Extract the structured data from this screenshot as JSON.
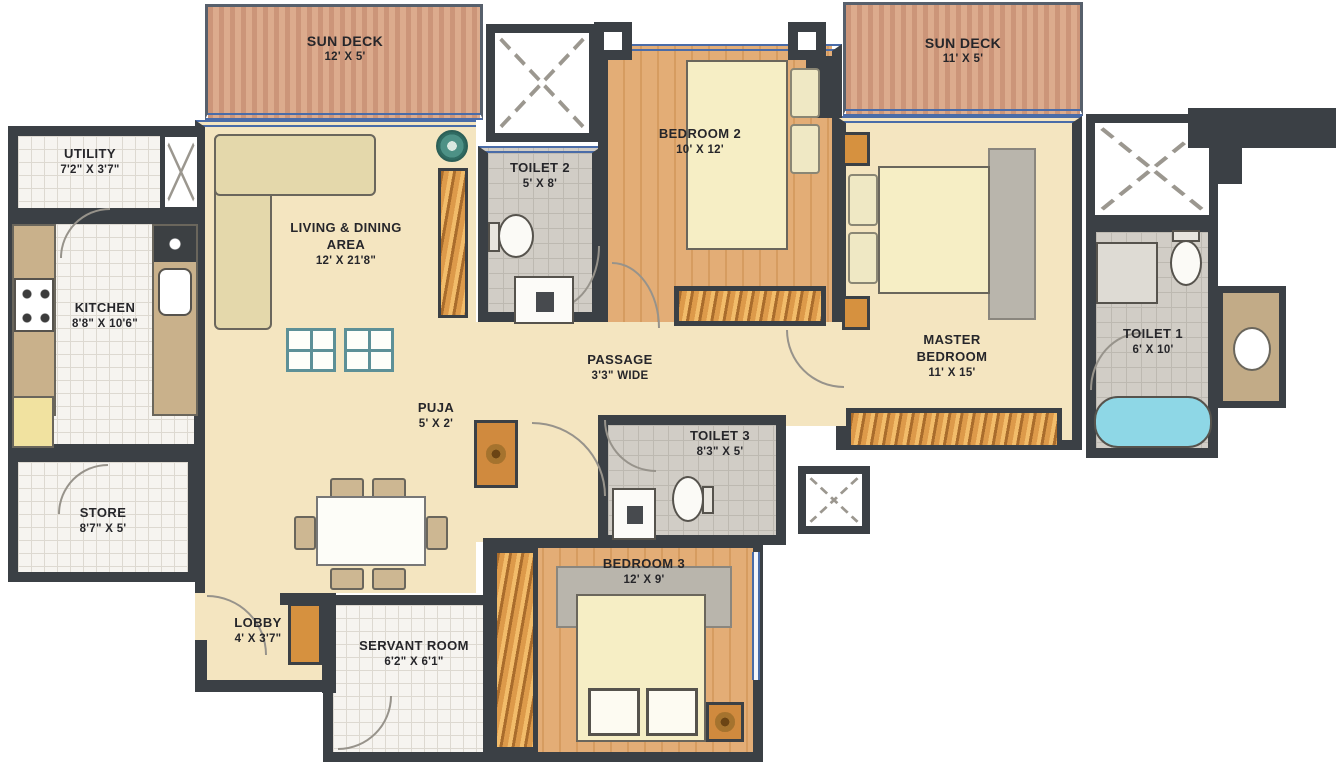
{
  "rooms": {
    "sun_deck_1": {
      "name": "SUN DECK",
      "dims": "12' X 5'"
    },
    "sun_deck_2": {
      "name": "SUN DECK",
      "dims": "11' X 5'"
    },
    "utility": {
      "name": "UTILITY",
      "dims": "7'2\" X 3'7\""
    },
    "kitchen": {
      "name": "KITCHEN",
      "dims": "8'8\" X 10'6\""
    },
    "living_dining": {
      "name": "LIVING & DINING AREA",
      "dims": "12' X 21'8\""
    },
    "toilet_2": {
      "name": "TOILET 2",
      "dims": "5' X 8'"
    },
    "bedroom_2": {
      "name": "BEDROOM 2",
      "dims": "10' X 12'"
    },
    "master_bedroom": {
      "name": "MASTER BEDROOM",
      "dims": "11' X 15'"
    },
    "toilet_1": {
      "name": "TOILET 1",
      "dims": "6' X 10'"
    },
    "passage": {
      "name": "PASSAGE",
      "dims": "3'3\" WIDE"
    },
    "puja": {
      "name": "PUJA",
      "dims": "5' X 2'"
    },
    "toilet_3": {
      "name": "TOILET 3",
      "dims": "8'3\" X 5'"
    },
    "store": {
      "name": "STORE",
      "dims": "8'7\" X 5'"
    },
    "lobby": {
      "name": "LOBBY",
      "dims": "4' X 3'7\""
    },
    "servant_room": {
      "name": "SERVANT ROOM",
      "dims": "6'2\" X 6'1\""
    },
    "bedroom_3": {
      "name": "BEDROOM 3",
      "dims": "12' X 9'"
    }
  },
  "colors": {
    "wall": "#3b4045",
    "floor_cream": "#f4e5c0",
    "floor_wood": "#dfa76e",
    "deck_wood": "#d09d80",
    "tile_white": "#f6f4f0",
    "tile_gray": "#d1cdc6",
    "window_blue": "#4a6ca8",
    "bathtub_cyan": "#8ed7e6",
    "wardrobe_orange": "#dd9a4a",
    "door_orange": "#d6913f",
    "label_text": "#26262a"
  }
}
